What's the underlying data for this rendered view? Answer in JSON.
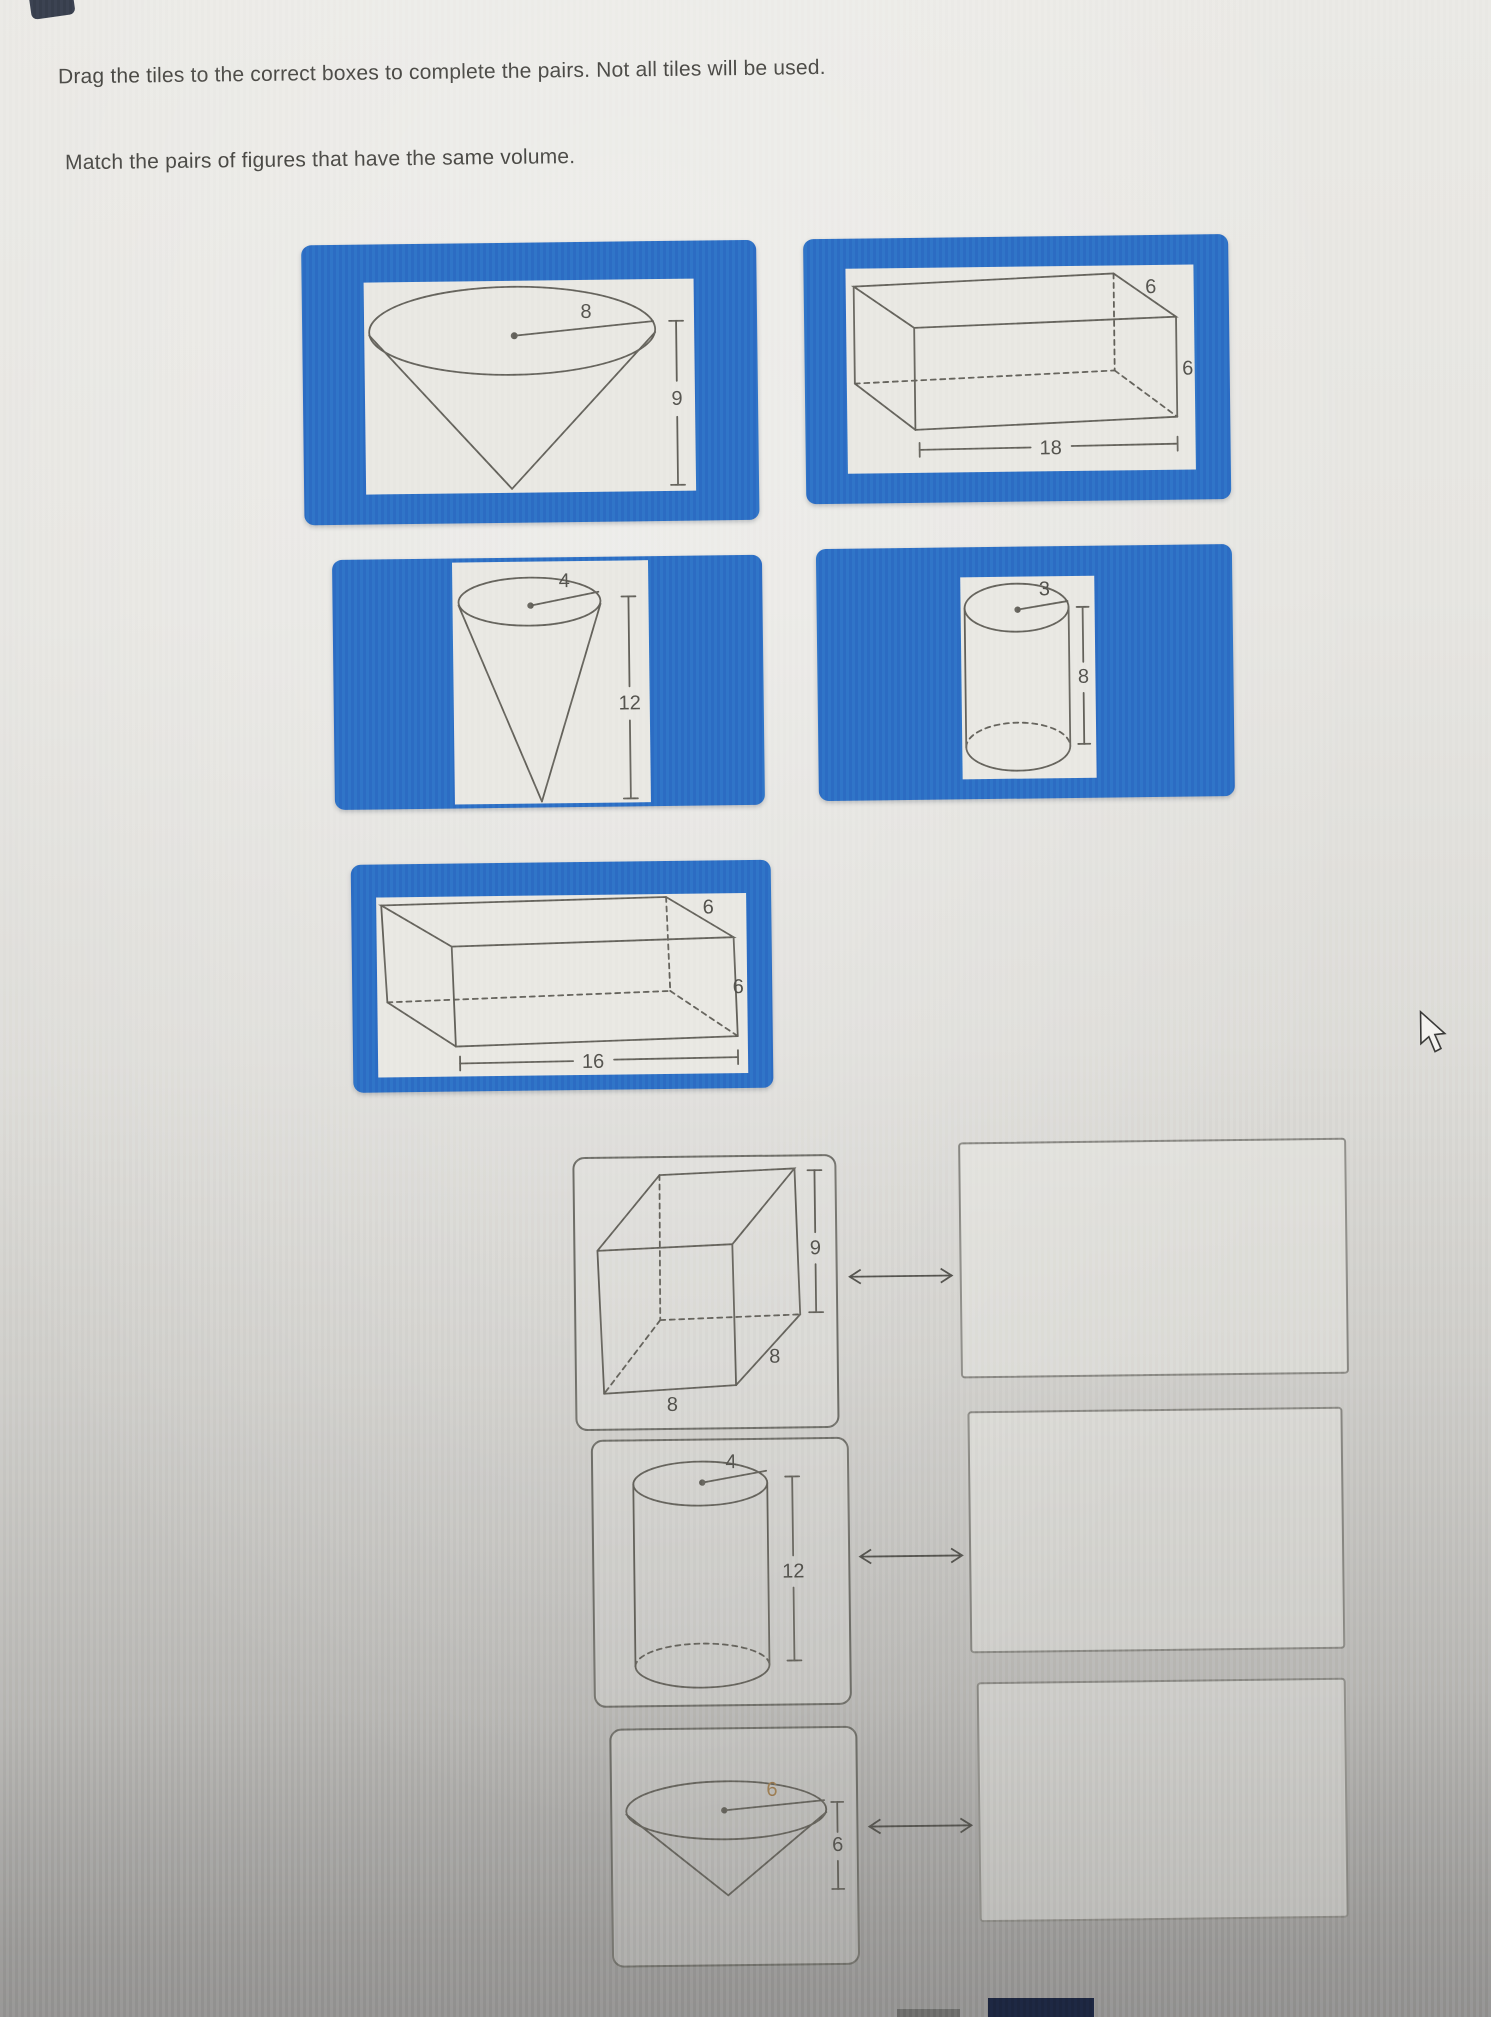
{
  "instructions": {
    "line1": "Drag the tiles to the correct boxes to complete the pairs. Not all tiles will be used.",
    "line2": "Match the pairs of figures that have the same volume."
  },
  "tiles": [
    {
      "name": "cone-radius-8-height-9",
      "shape": "cone",
      "labels": {
        "radius": "8",
        "height": "9"
      }
    },
    {
      "name": "prism-18-6-6",
      "shape": "rectangular-prism",
      "labels": {
        "length": "18",
        "depth": "6",
        "height": "6"
      }
    },
    {
      "name": "cone-radius-4-height-12",
      "shape": "cone",
      "labels": {
        "radius": "4",
        "height": "12"
      }
    },
    {
      "name": "cylinder-radius-3-height-8",
      "shape": "cylinder",
      "labels": {
        "radius": "3",
        "height": "8"
      }
    },
    {
      "name": "prism-16-6-6",
      "shape": "rectangular-prism",
      "labels": {
        "length": "16",
        "depth": "6",
        "height": "6"
      }
    }
  ],
  "match_targets": [
    {
      "name": "prism-8-8-9",
      "shape": "rectangular-prism",
      "labels": {
        "height": "9",
        "depth": "8",
        "width": "8"
      }
    },
    {
      "name": "cylinder-radius-4-height-12",
      "shape": "cylinder",
      "labels": {
        "radius": "4",
        "height": "12"
      }
    },
    {
      "name": "cone-radius-6-height-6",
      "shape": "cone",
      "labels": {
        "radius": "6",
        "height": "6"
      }
    }
  ],
  "colors": {
    "tile_blue": "#2d6fc5",
    "panel_bg": "#e9e8e3",
    "figure_stroke": "#66645d",
    "accent_label": "#9a7a50"
  }
}
